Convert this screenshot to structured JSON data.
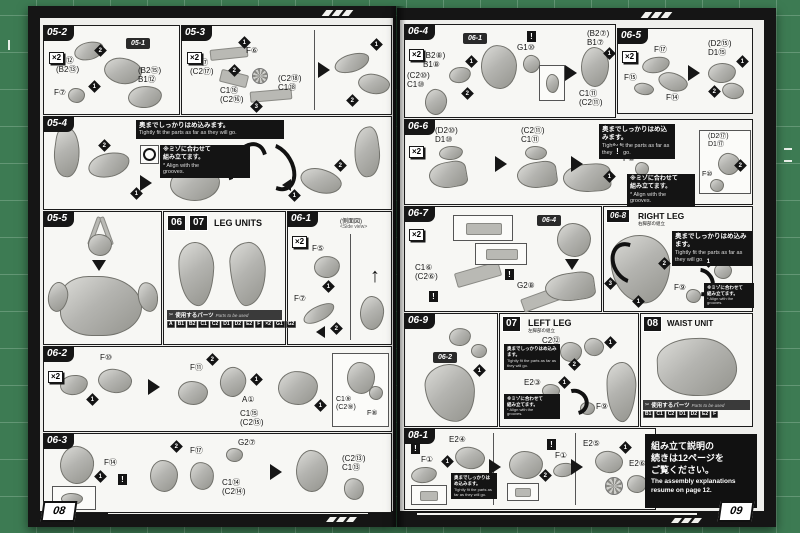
{
  "colors": {
    "mat_green": "#3d7b53",
    "frame_black": "#151515",
    "paper_white": "#f7f7f4"
  },
  "shared": {
    "multiplier": "×2",
    "bang": "!",
    "m1": "1",
    "m2": "2",
    "m3": "3",
    "warning_fit_jp": "奥までしっかりはめ込みます。",
    "warning_fit_en": "Tightly fit the parts as far as they will go.",
    "note_groove_jp": "※ミゾに合わせて\n組み立てます。",
    "note_groove_en": "* Align with the\ngrooves.",
    "parts_used_jp": "使用するパーツ",
    "parts_used_en": "Parts to be used"
  },
  "p08": {
    "page_number": "08",
    "s052": {
      "tag": "05-2",
      "ref": "05-1",
      "l1": "B1⑫\n(B2⑬)",
      "l2": "F⑦",
      "l3": "(B2⑮)\nB1⑫"
    },
    "s053": {
      "tag": "05-3",
      "l1": "C1⑰\n(C2⑰)",
      "l2": "F⑥",
      "l3": "C1⑯\n(C2⑯)",
      "l4": "(C2⑱)\nC1⑱"
    },
    "s054": {
      "tag": "05-4"
    },
    "s055": {
      "tag": "05-5"
    },
    "legunits": {
      "n1": "06",
      "n2": "07",
      "title": "LEG UNITS",
      "badges": [
        "A",
        "B1",
        "B2",
        "C1",
        "C2",
        "D1",
        "D2",
        "E2",
        "F",
        "×2",
        "G1",
        "G2"
      ]
    },
    "s061": {
      "tag": "06-1",
      "view_jp": "(側面図)",
      "view_en": "<Side view>",
      "l1": "F⑤",
      "l2": "F⑦"
    },
    "s062": {
      "tag": "06-2",
      "l1": "F⑩",
      "l2": "F⑪",
      "l3": "A①",
      "l4": "C1⑮\n(C2⑮)",
      "i1": "C1⑨\n(C2⑨)",
      "i2": "F⑧"
    },
    "s063": {
      "tag": "06-3",
      "l1": "F⑭",
      "l2": "F⑰",
      "l3": "G2⑦",
      "l4": "C1⑭\n(C2⑭)",
      "l5": "(C2⑬)\nC1⑬"
    }
  },
  "p09": {
    "page_number": "09",
    "s064": {
      "tag": "06-4",
      "ref": "06-1",
      "l1": "(B2⑧)\nB1⑧",
      "l2": "(C2⑩)\nC1⑩",
      "l3": "G1⑩",
      "l4": "(B2⑦)\nB1⑦",
      "l5": "C1⑪\n(C2⑪)"
    },
    "s065": {
      "tag": "06-5",
      "l1": "F⑰",
      "l2": "F⑮",
      "l3": "F⑭",
      "l4": "(D2⑮)\nD1⑮"
    },
    "s066": {
      "tag": "06-6",
      "l1": "(D2⑩)\nD1⑩",
      "l2": "(C2⑪)\nC1⑪",
      "l3": "F⑧",
      "i1": "(D2⑰)\nD1⑰",
      "i2": "F⑩"
    },
    "s067": {
      "tag": "06-7",
      "ref": "06-4",
      "l1": "C1⑥\n(C2⑥)",
      "l2": "G2⑧"
    },
    "s068": {
      "tag": "06-8",
      "title": "RIGHT LEG",
      "subtitle": "右脚部の組立",
      "l1": "E2④",
      "l2": "F⑨"
    },
    "s069": {
      "tag": "06-9",
      "ref": "06-2"
    },
    "s07": {
      "tag": "07",
      "title": "LEFT LEG",
      "subtitle": "左脚部の組立",
      "l1": "C2⑫",
      "l2": "E2③",
      "l3": "F⑨"
    },
    "s08": {
      "tag": "08",
      "title": "WAIST UNIT",
      "badges": [
        "B1",
        "C1",
        "C2",
        "D1",
        "D2",
        "E2",
        "F"
      ]
    },
    "s081": {
      "tag": "08-1",
      "l1": "F①",
      "l2": "E2④",
      "l3": "F①",
      "l4": "E2⑤",
      "l5": "E2⑥"
    },
    "announce": {
      "jp1": "組み立て説明の",
      "jp2": "続きは12ページを",
      "jp3": "ご覧ください。",
      "en1": "The assembly explanations",
      "en2": "resume on page 12."
    }
  }
}
